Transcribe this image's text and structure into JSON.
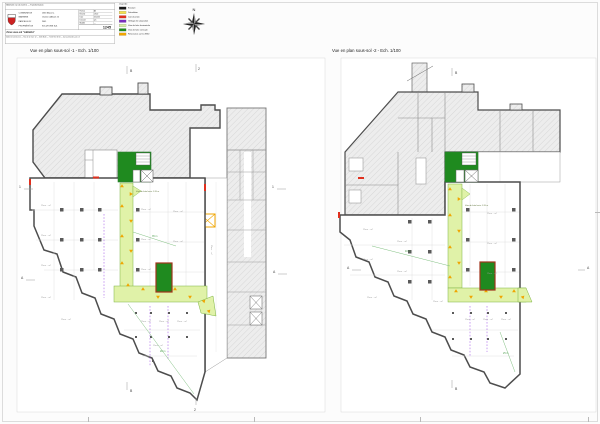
{
  "title_block": {
    "header": "Bâtiment rue du Centre — Transformation",
    "org_labels": [
      "COMMUNE DE",
      "MARSENS",
      "PARCELLE N°",
      "PROPRIÉTÉ DE"
    ],
    "org_values": [
      "1633 Marsens",
      "Chemin d'Amont 25",
      "2441",
      "SOLUTIONS S.A."
    ],
    "table_rows": [
      {
        "label": "Format",
        "value": "A3"
      },
      {
        "label": "Échelle",
        "value": "1/100"
      },
      {
        "label": "Date",
        "value": "05.2015"
      },
      {
        "label": "Dessiné",
        "value": "pm"
      },
      {
        "label": "Modifié",
        "value": "—"
      }
    ],
    "doc_number": "1245",
    "zone_band": "Zone sous-sol \"cafétéria\"",
    "footer": "Atelier d'architecture — Rue de la Gare 12 — 1630 Bulle — T 026 912 34 56 — bureau@atelier-arch.ch"
  },
  "legend": {
    "title": "Légende",
    "items": [
      {
        "label": "Existant",
        "color": "#1a1a1a"
      },
      {
        "label": "Démolition",
        "color": "#f4e04d"
      },
      {
        "label": "Construction",
        "color": "#e0301e"
      },
      {
        "label": "Grillage de séparation",
        "color": "#7b2fbe"
      },
      {
        "label": "Voie de fuite horizontale",
        "color": "#d9efa5"
      },
      {
        "label": "Voie de fuite verticale",
        "color": "#1f8a1f"
      },
      {
        "label": "Résistance au feu EI30",
        "color": "#f0a500"
      }
    ]
  },
  "compass": {
    "north": "N"
  },
  "plans": {
    "p1": {
      "title": "Vue en plan sous-sol -1 - Ech. 1/100",
      "grid": {
        "top_b": "B",
        "top_2": "2",
        "left_1": "1",
        "left_a": "A",
        "right_1": "1",
        "right_a": "A",
        "bottom_b": "B",
        "bottom_2": "2"
      },
      "corridor_label": "Voie de fuite horiz. 1.20 m",
      "route_label_1": "35 m",
      "route_label_2": "28 m",
      "place_label": "Place ·· m²"
    },
    "p2": {
      "title": "Vue en plan sous-sol -2 - Ech. 1/100",
      "grid": {
        "top_b": "B",
        "left_a": "A",
        "right_a": "A",
        "bottom_b": "B"
      },
      "corridor_label": "Voie de fuite horiz. 1.20 m",
      "route_label_1": "40 m",
      "route_label_2": "25 m",
      "place_label": "Place ·· m²"
    }
  }
}
